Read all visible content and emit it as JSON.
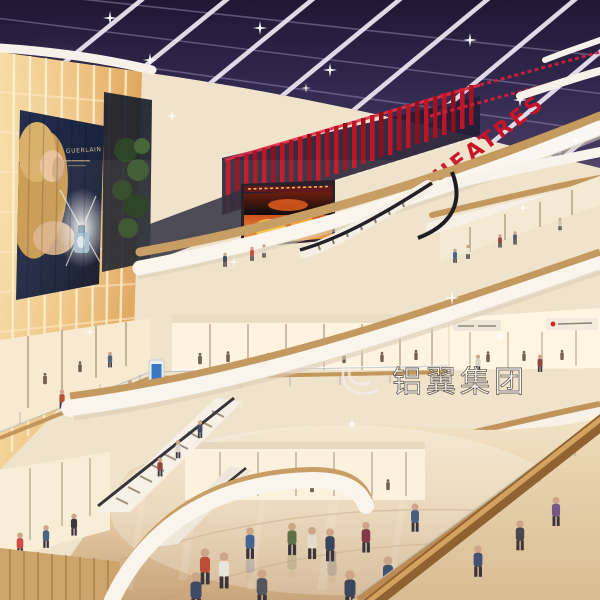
{
  "scene_title": "Shopping mall atrium rendering",
  "signs": {
    "theatre": "THEATRES",
    "billboard_brand": "GUERLAIN",
    "watermark": "铝翼集团"
  },
  "colors": {
    "theatre_red": "#c81428",
    "ceiling_navy": "#322b4e",
    "lightbox_amber": "#f0c27e",
    "arc_white": "#f8f4ec",
    "wood": "#bf9254",
    "floor_beige": "#ddc49e",
    "fire_orange": "#e8641e"
  }
}
